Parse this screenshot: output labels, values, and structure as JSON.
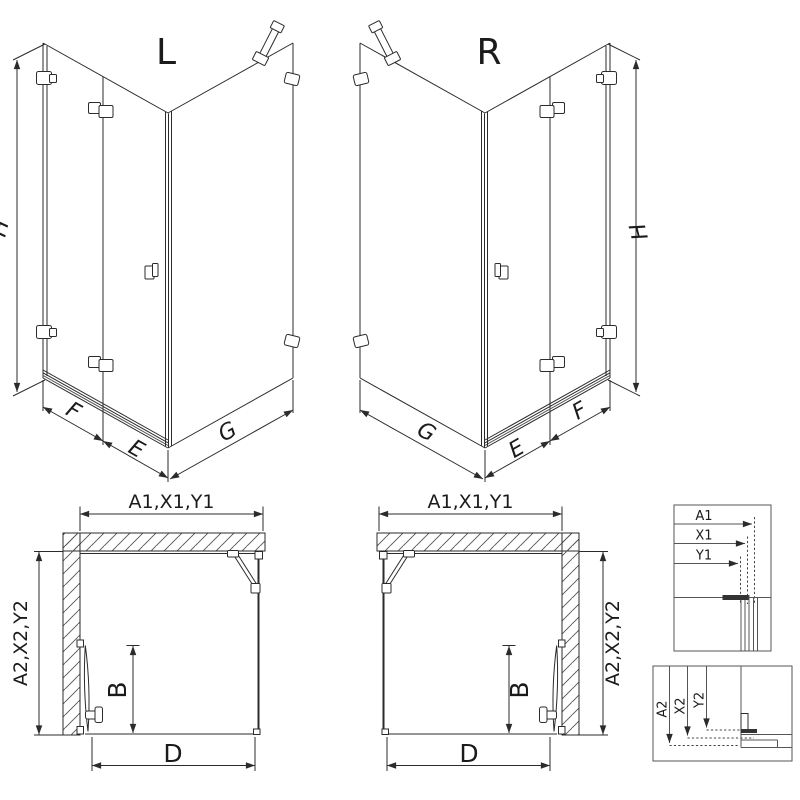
{
  "page": {
    "background_color": "#ffffff",
    "line_color": "#2b2b2b"
  },
  "iso_left": {
    "variant_label": "L",
    "height_dim": "H",
    "fixed_panel_dim": "F",
    "door_dim": "E",
    "side_panel_dim": "G"
  },
  "iso_right": {
    "variant_label": "R",
    "height_dim": "H",
    "fixed_panel_dim": "F",
    "door_dim": "E",
    "side_panel_dim": "G"
  },
  "plan_left": {
    "width_dims": "A1,X1,Y1",
    "depth_dims": "A2,X2,Y2",
    "door_projection_dim": "B",
    "entry_width_dim": "D"
  },
  "plan_right": {
    "width_dims": "A1,X1,Y1",
    "depth_dims": "A2,X2,Y2",
    "door_projection_dim": "B",
    "entry_width_dim": "D"
  },
  "width_detail": {
    "labels": [
      "A1",
      "X1",
      "Y1"
    ]
  },
  "depth_detail": {
    "labels": [
      "A2",
      "X2",
      "Y2"
    ]
  }
}
